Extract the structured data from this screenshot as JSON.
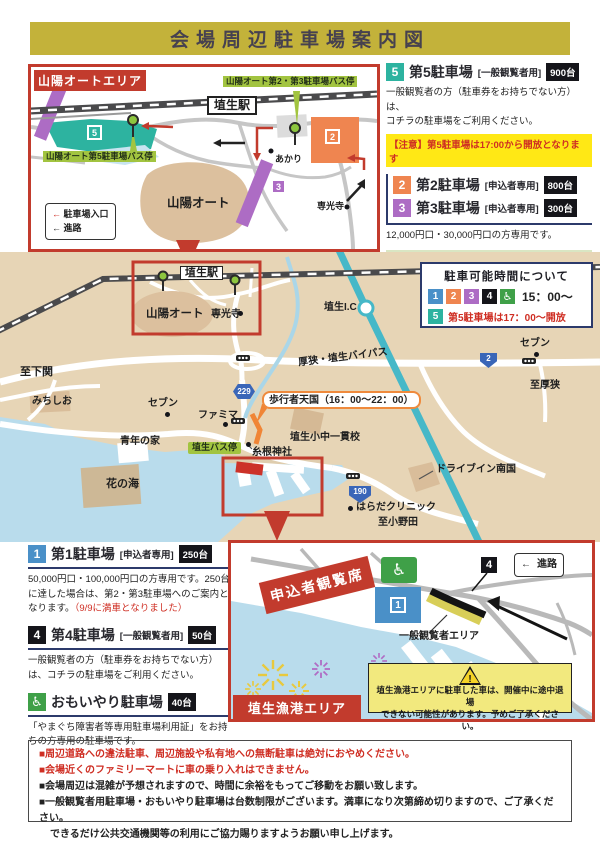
{
  "title": "会場周辺駐車場案内図",
  "icons": {
    "arrow_left": "←",
    "wheelchair": "♿",
    "warning_mark": "!"
  },
  "colors": {
    "accent_red": "#c23b2d",
    "title_bg": "#c3b23a",
    "lot1_blue": "#4a90c8",
    "lot2_orange": "#ef8550",
    "lot3_purple": "#ad6cc4",
    "lot4_black": "#15151a",
    "lot5_teal": "#2db3a0",
    "care_green": "#3fa048",
    "notice_yellow": "#ffe815",
    "map_tan": "#e7d5b6",
    "water_blue": "#b9dcec",
    "highway_teal": "#46b8c8",
    "busstop_green": "#a2c440",
    "navy": "#2c3a6b"
  },
  "auto_inset": {
    "header": "山陽オートエリア",
    "station": "埴生駅",
    "bus_stop_23": "山陽オート第2・第3駐車場バス停",
    "bus_stop_5": "山陽オート第5駐車場バス停",
    "sanyo_auto": "山陽オート",
    "akari": "あかり",
    "senkoji": "専光寺",
    "badge2": "2",
    "badge3": "3",
    "badge5": "5",
    "legend": {
      "entrance": "駐車場入口",
      "route": "進路"
    }
  },
  "lots_right": {
    "lot5": {
      "num": "5",
      "name": "第5駐車場",
      "type": "[一般観覧者用]",
      "capacity": "900台",
      "desc1": "一般観覧者の方（駐車券をお持ちでない方）は、",
      "desc2": "コチラの駐車場をご利用ください。",
      "notice": "【注意】第5駐車場は17:00から開放となります"
    },
    "lot2": {
      "num": "2",
      "name": "第2駐車場",
      "type": "[申込者専用]",
      "capacity": "800台"
    },
    "lot3": {
      "num": "3",
      "name": "第3駐車場",
      "type": "[申込者専用]",
      "capacity": "300台"
    },
    "lot23_desc": "12,000円口・30,000円口の方専用です。",
    "shuttle": {
      "line1": "山陽オートエリアから会場近くまで",
      "line2": "無料シャトルバスが運行します。",
      "line3": "【16：00～23：00まで運行予定】"
    }
  },
  "hours_box": {
    "title": "駐車可能時間について",
    "b1": "1",
    "b2": "2",
    "b3": "3",
    "b4": "4",
    "time": "15：00～",
    "b5": "5",
    "note5": "第5駐車場は17：00～開放"
  },
  "main_map": {
    "station": "埴生駅",
    "sanyo_auto": "山陽オート",
    "senkoji": "専光寺",
    "to_shimonoseki": "至下関",
    "michishio": "みちしお",
    "seven_left": "セブン",
    "famima": "ファミマ",
    "seinen_no_ie": "青年の家",
    "hana_no_umi": "花の海",
    "habu_bus_stop": "埴生バス停",
    "itone_shrine": "糸根神社",
    "school": "埴生小中一貫校",
    "habu_ic": "埴生I.C",
    "bypass": "厚狭・埴生バイパス",
    "seven_right": "セブン",
    "to_asa": "至厚狭",
    "drivein_nangoku": "ドライブイン南国",
    "harada_clinic": "はらだクリニック",
    "to_onoda": "至小野田",
    "hokosha_tengoku": "歩行者天国（16：00～22：00）",
    "route229": "229",
    "route2": "2",
    "route190": "190"
  },
  "lots_left": {
    "lot1": {
      "num": "1",
      "name": "第1駐車場",
      "type": "[申込者専用]",
      "capacity": "250台",
      "desc": "50,000円口・100,000円口の方専用です。250台に達した場合は、第2・第3駐車場へのご案内となります。",
      "desc_red": "（9/9に満車となりました）"
    },
    "lot4": {
      "num": "4",
      "name": "第4駐車場",
      "type": "[一般観覧者用]",
      "capacity": "50台",
      "desc": "一般観覧者の方（駐車券をお持ちでない方）は、コチラの駐車場をご利用ください。"
    },
    "lot_care": {
      "name": "おもいやり駐車場",
      "capacity": "40台",
      "desc": "「やまぐち障害者等専用駐車場利用証」をお持ちの方専用の駐車場です。"
    }
  },
  "harbor_inset": {
    "stand_banner": "申込者観覧席",
    "badge1": "1",
    "badge4": "4",
    "general_area": "一般観覧者エリア",
    "legend_route": "進路",
    "warning1": "埴生漁港エリアに駐車した車は、開催中に途中退場",
    "warning2": "できない可能性があります。予めご了承ください。",
    "area_name": "埴生漁港エリア"
  },
  "notes": {
    "lines": [
      "■周辺道路への違法駐車、周辺施設や私有地への無断駐車は絶対におやめください。",
      "■会場近くのファミリーマートに車の乗り入れはできません。",
      "■会場周辺は混雑が予想されますので、時間に余裕をもってご移動をお願い致します。",
      "■一般観覧者用駐車場・おもいやり駐車場は台数制限がございます。満車になり次第締め切りますので、ご了承ください。",
      "できるだけ公共交通機関等の利用にご協力賜りますようお願い申し上げます。"
    ]
  }
}
